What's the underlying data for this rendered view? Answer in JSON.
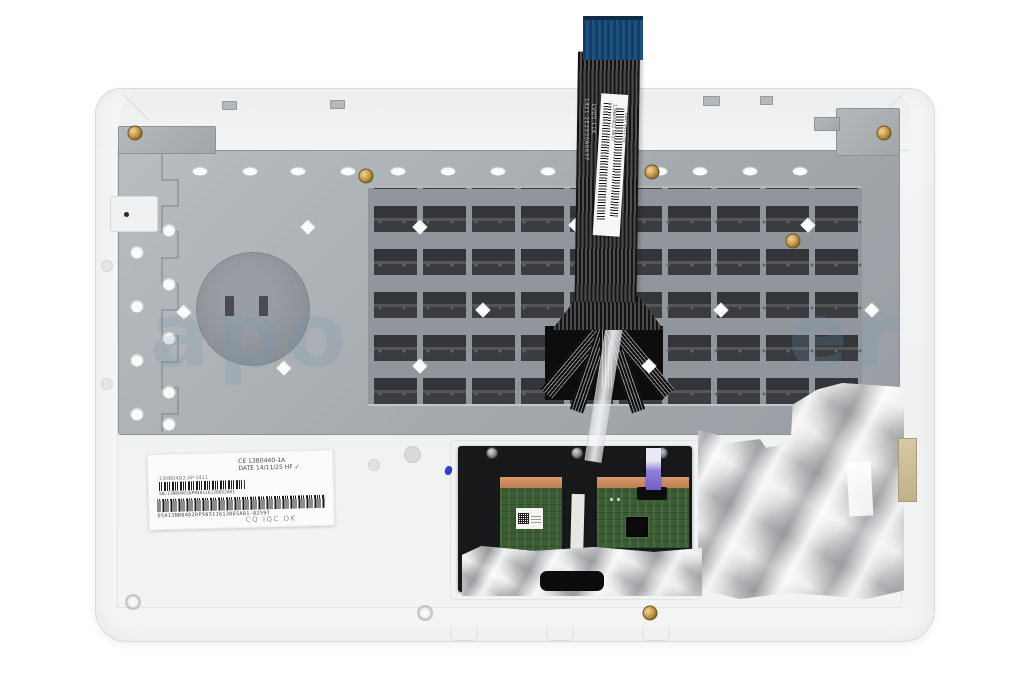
{
  "colors": {
    "palmrest": "#f2f3f5",
    "plate": "#a8adb1",
    "keyboard_dark": "#3a3c3f",
    "cable_dark": "#2b2b2b",
    "cable_tip_blue": "#1d517f",
    "pcb_green": "#3a5c33",
    "copper": "#c8845c",
    "connector_purple": "#8d7fd6",
    "foil": "#c9cacc",
    "watermark": "rgba(115,150,175,0.22)"
  },
  "watermark": {
    "letters": [
      "a",
      "p",
      "o",
      "e",
      "r"
    ]
  },
  "keyboard_cable": {
    "print_line1": "1421-2E2030A0637",
    "print_line2": "LVD5-L1K",
    "label_col1": "13NB04D2 0637",
    "label_col2": "KBD 1411 US"
  },
  "service_label": {
    "note_line1": "CE 13B0440-1A",
    "note_line2": "DATE 14/11/25 HF ✓",
    "code_top": "13NB04D2-AP-1411",
    "barcode1_caption": "SN:13NB04D2AP0401161306S2A01",
    "barcode2_caption": "D5A13NB04D2RP50511613065A01-02597",
    "stamp": "CQ IQC OK"
  }
}
